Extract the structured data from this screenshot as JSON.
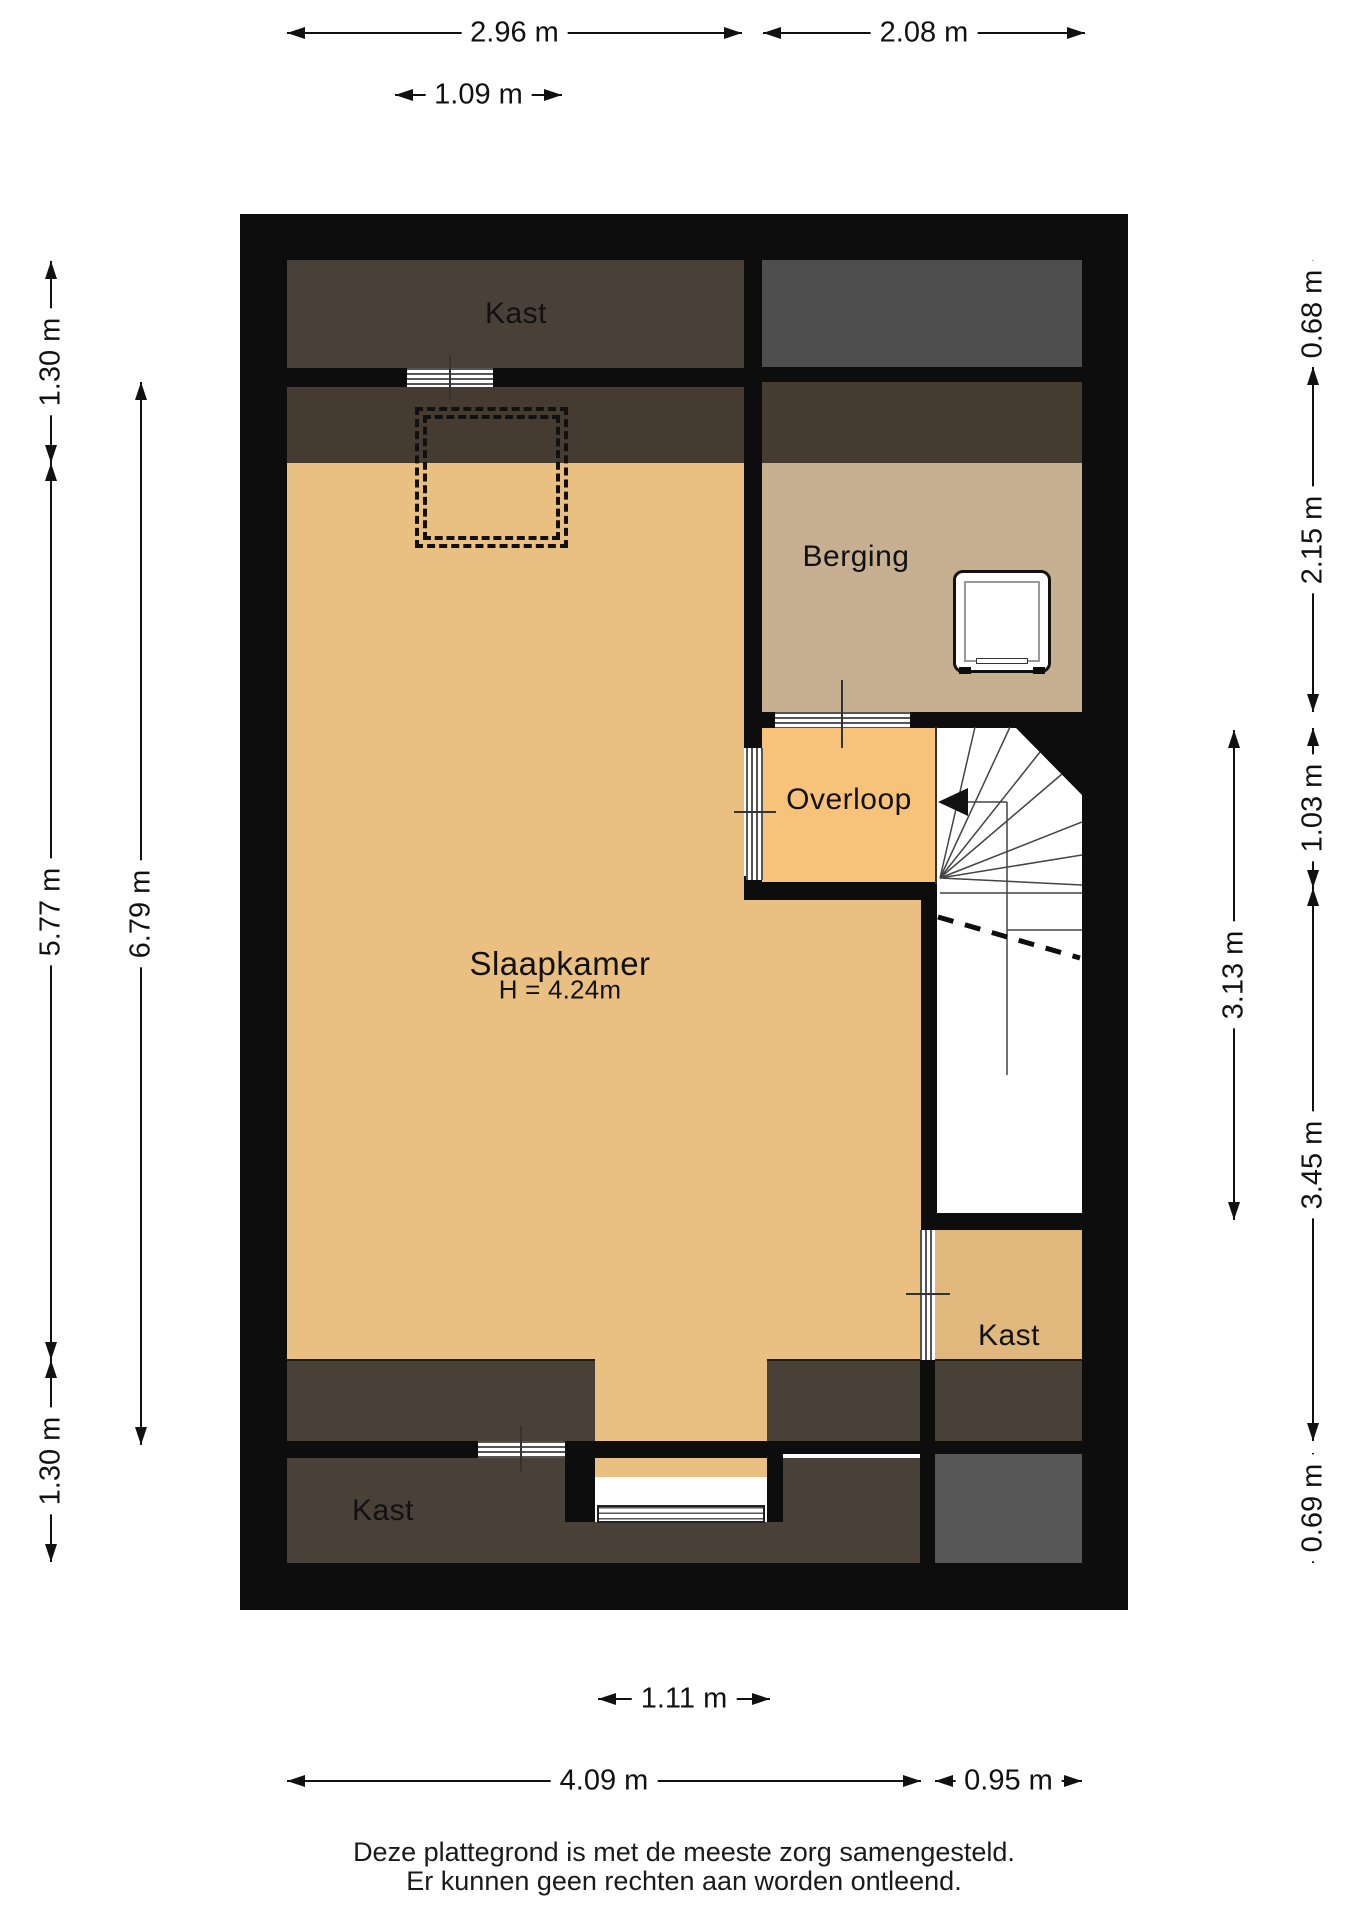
{
  "floorplan": {
    "rooms": {
      "kast_top": {
        "label": "Kast"
      },
      "berging": {
        "label": "Berging"
      },
      "overloop": {
        "label": "Overloop"
      },
      "slaapkamer": {
        "label": "Slaapkamer",
        "height_note": "H = 4.24m"
      },
      "kast_right": {
        "label": "Kast"
      },
      "kast_bottom": {
        "label": "Kast"
      }
    },
    "dimensions": {
      "top": {
        "width_left": "2.96 m",
        "width_right": "2.08 m",
        "dormer_width": "1.09 m"
      },
      "bottom": {
        "window_width": "1.11 m",
        "width_main": "4.09 m",
        "width_stairs": "0.95 m"
      },
      "left": {
        "kast_depth_top": "1.30 m",
        "slaapkamer_height": "5.77 m",
        "kast_depth_bottom": "1.30 m",
        "inner_height": "6.79 m"
      },
      "right": {
        "attic_top": "0.68 m",
        "berging_height": "2.15 m",
        "overloop_height": "1.03 m",
        "stairwell_height": "3.13 m",
        "lower_height": "3.45 m",
        "attic_bottom": "0.69 m"
      }
    },
    "footer": {
      "line1": "Deze plattegrond is met de meeste zorg samengesteld.",
      "line2": "Er kunnen geen rechten aan worden ontleend."
    },
    "colors": {
      "wall": "#0d0d0d",
      "closet_dark_brown": "#494037",
      "sloped_strip_brown": "#453b31",
      "attic_gray_top": "#4d4d4d",
      "attic_gray_bottom": "#575757",
      "slaapkamer_floor": "#e9bf82",
      "overloop_floor": "#f7c37b",
      "kast_right_floor": "#e0b87e",
      "berging_floor": "#c7b092",
      "background": "#ffffff"
    }
  }
}
